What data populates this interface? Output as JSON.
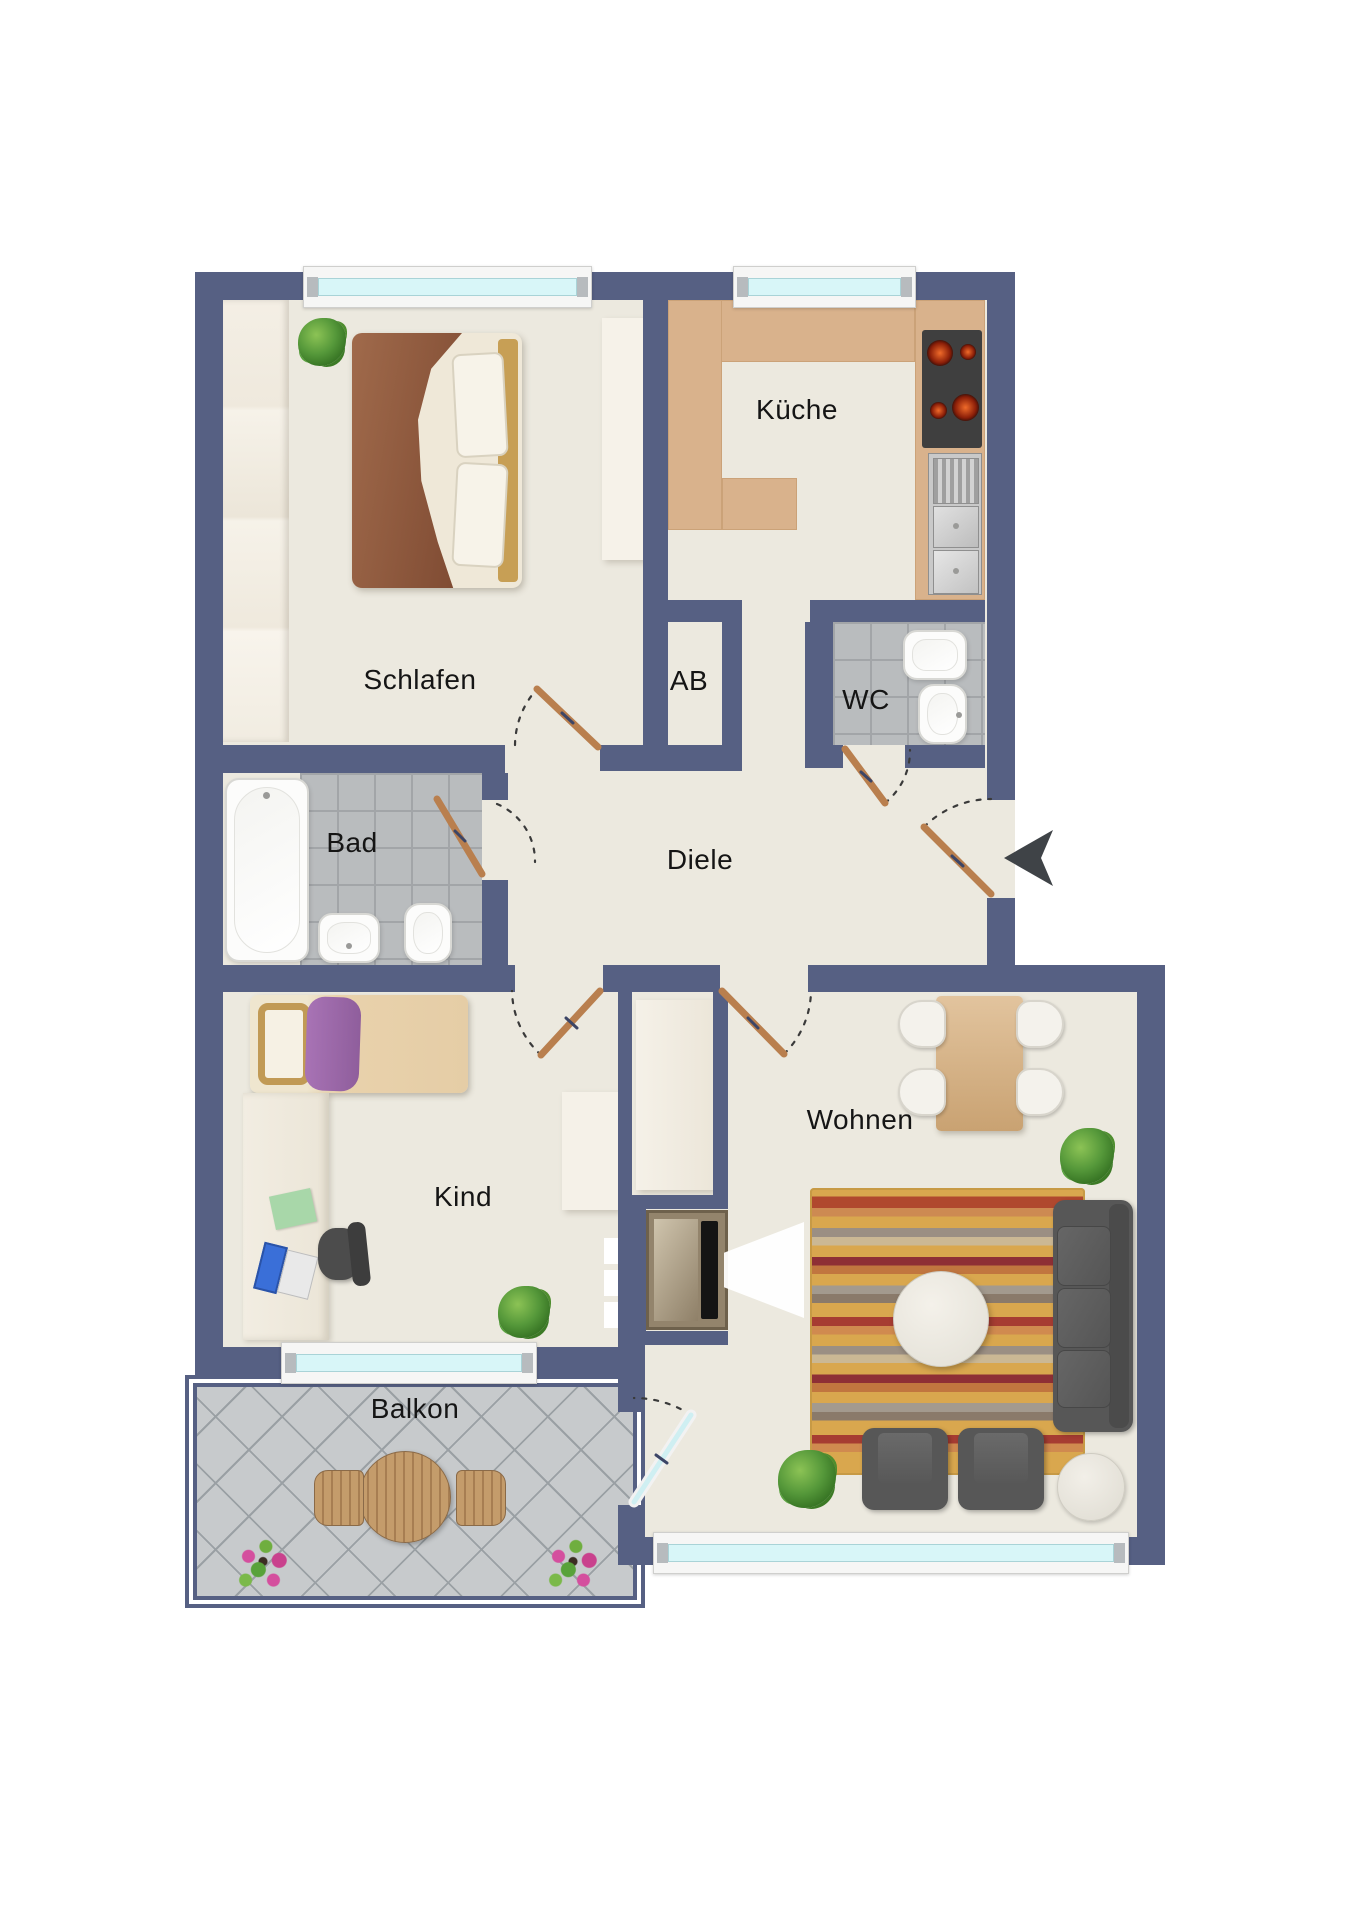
{
  "plan": {
    "type": "apartment-floorplan",
    "rooms": [
      {
        "id": "schlafen",
        "label": "Schlafen"
      },
      {
        "id": "kueche",
        "label": "Küche"
      },
      {
        "id": "ab",
        "label": "AB"
      },
      {
        "id": "wc",
        "label": "WC"
      },
      {
        "id": "bad",
        "label": "Bad"
      },
      {
        "id": "diele",
        "label": "Diele"
      },
      {
        "id": "kind",
        "label": "Kind"
      },
      {
        "id": "wohnen",
        "label": "Wohnen"
      },
      {
        "id": "balkon",
        "label": "Balkon"
      }
    ],
    "entrance": {
      "icon": "entrance-arrow-left"
    },
    "colors": {
      "wall": "#566083",
      "floor": "#ECE9DF",
      "kitchen_counter": "#D9B28C",
      "bath_tile": "#B9BCBE",
      "balcony_tile": "#C7CACC",
      "window_glass": "#D8F6F8",
      "door_leaf": "#B97F4E",
      "sofa": "#575757",
      "rug_base": "#D9A74E"
    }
  }
}
